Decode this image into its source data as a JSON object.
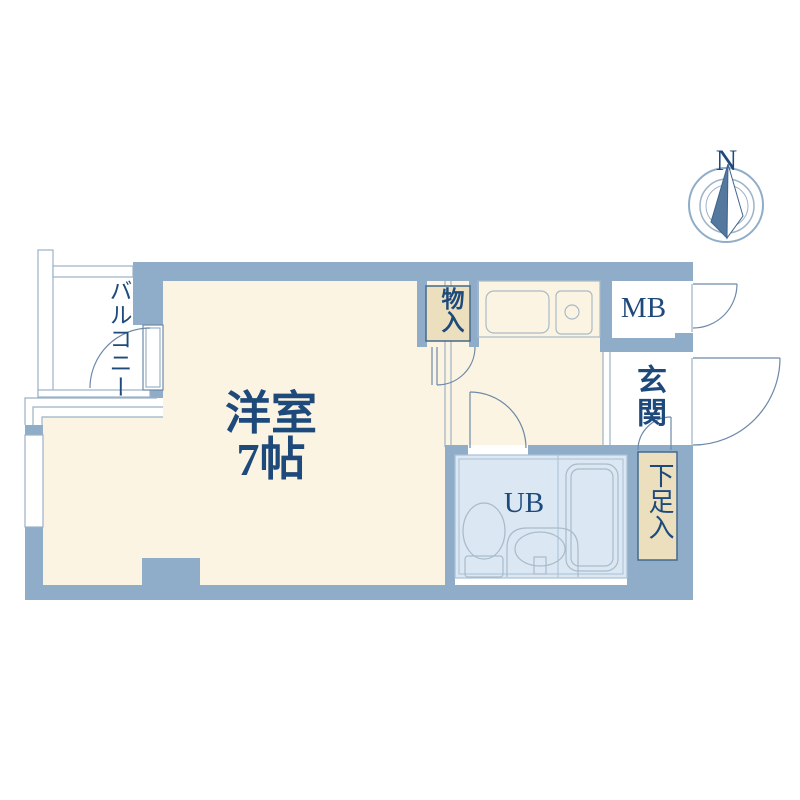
{
  "title": "apartment-floor-plan",
  "compass": {
    "north_label": "N"
  },
  "rooms": {
    "balcony": "バルコニー",
    "western_room": "洋室",
    "western_room_size": "7帖",
    "storage": "物入",
    "meter_box": "MB",
    "entrance": "玄関",
    "shoe_box": "下足入",
    "unit_bath": "UB"
  },
  "palette": {
    "wall_blue": "#8fadc9",
    "floor_cream": "#fcf4e2",
    "closet_tan": "#ebdfbe",
    "bath_blue": "#dbe8f3",
    "text_navy": "#1e4a7b",
    "thin_line": "#9bb1c6",
    "door_arc": "#6d89a8"
  }
}
